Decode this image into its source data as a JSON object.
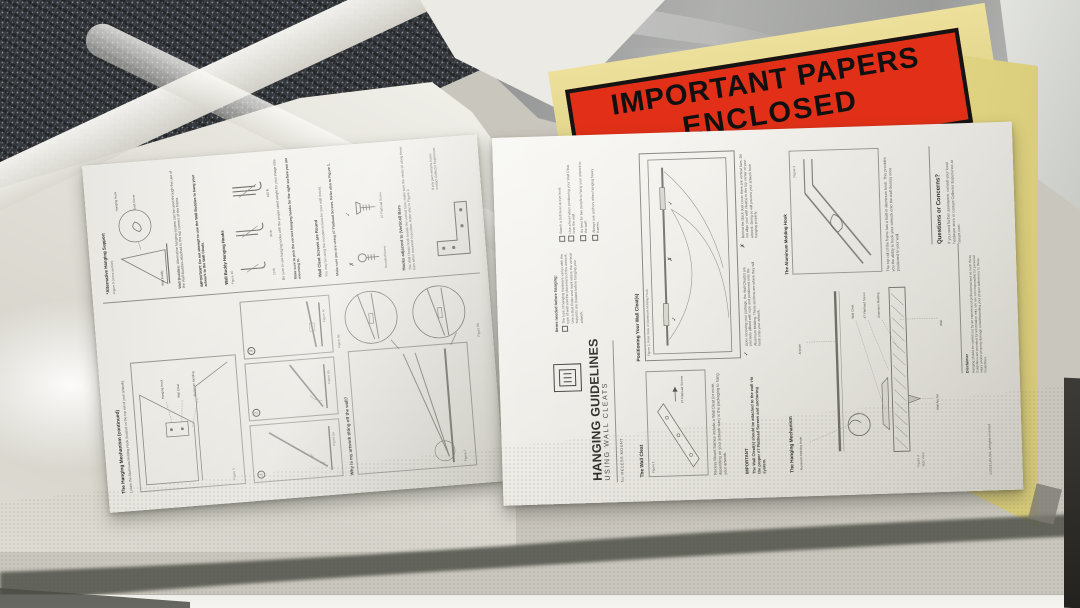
{
  "envelope": {
    "line1": "IMPORTANT PAPERS",
    "line2": "ENCLOSED"
  },
  "marks": {
    "check": "✓",
    "cross": "✗"
  },
  "right": {
    "title": "HANGING GUIDELINES",
    "subtitle": "USING WALL CLEATS",
    "for_line": "for RECESS MOUNT",
    "checklist": {
      "header": "Items needed before hanging:",
      "items": [
        "The type of hanging hardware varies with the type of wall and the placement of the artwork. Use a stud finder and mark where the vertical supports are located before hanging your artwork.",
        "Attach a bolt level at eye level.",
        "Use a level when positioning your Wall Cleat onto the wall.",
        "It's best for two people to hang your artwork to the wall.",
        "Always use anchors when hanging heavy frames."
      ]
    },
    "wall_cleat": {
      "header": "The Wall Cleat",
      "figure": "Figure 1",
      "screw_label": "#7 Flathead Screws",
      "body": "Recess Mount frames include a Wall Cleat (or more, depending on your artwork size) in the packaging to hang your artwork.",
      "important_header": "IMPORTANT",
      "important_body": "The Wall Cleat(s) should be attached to the wall via the proper #7 Flathead Screws and anchoring system."
    },
    "positioning": {
      "header": "Positioning Your Wall Cleat(s)",
      "figure": "Figure 2, Rear View of Aluminum Molding Hook",
      "caption_good": "Upon receiving your package, the Wall Cleat(s) are precisely affixed with rope and positioned onto the Aluminum Molding. These sections are where they will hook onto your artwork.",
      "caption_bad": "Behind the black dust cover there are vertical bars. Do not align your wall cleat(s) to the top center of your artwork. Doing so will prevent your artwork from hanging properly."
    },
    "mechanism": {
      "header": "The Hanging Mechanism",
      "figure": "Figure 4",
      "figure_sub": "Side View",
      "labels": [
        "Aluminum Molding Hook",
        "Artwork",
        "Wall Cleat",
        "#7 Flathead Screw",
        "Aluminum Molding",
        "Wall Anchor",
        "Wall"
      ]
    },
    "molding_hook": {
      "header": "The Aluminum Molding Hook",
      "figure": "Figure 3",
      "body": "The top rail of the frame has a built-in aluminum hook. This provides you the ability to hook your artwork onto the wall cleat(s) once positioned to your wall."
    },
    "questions": {
      "header": "Questions or Concerns?",
      "body": "If you need further assistance, consult your local hardware store or contact Collector Experience at riseart.com."
    },
    "footer": {
      "disclaimer_header": "Disclaimer",
      "disclaimer_body": "Hanging should be carried out by an experienced professional and as such these Guidelines are provided for information only. We are not responsible for personal injury and/or property damage notwithstanding your proper adherence to these Guidelines.",
      "copyright": "©2019 UA USA, all rights reserved"
    }
  },
  "left": {
    "mechanism2": {
      "header": "The Hanging Mechanism (continued)",
      "sub": "Locate the Aluminum Molding Hook (located on the top rail of your artwork).",
      "figure": "Figure 5",
      "labels": [
        "Hanging Hook",
        "Wall Cleat",
        "Aluminum Molding"
      ]
    },
    "steps": {
      "items": [
        {
          "num": "1",
          "figure": "Figure 6a"
        },
        {
          "num": "2",
          "figure": "Figure 6b"
        },
        {
          "num": "3",
          "figure": "Figure 6c"
        }
      ]
    },
    "tilting": {
      "header": "Why is my artwork tilting off the wall?",
      "figure_main": "Figure 7",
      "figure_a": "Figure 8a",
      "figure_b": "Figure 8b"
    },
    "alt_support": {
      "header": "*Alternative Hanging Support",
      "figure": "Figure 9 (cross section)",
      "labels": [
        "Hanging Hook",
        "Wall Buddy",
        "Dust Cover"
      ],
      "body_header": "Wall Buddies:",
      "body": "Alternative hanging system can be used through the use of the Wall Buddies attached to the top corners of the frame.",
      "important": "IMPORTANT: Do not attempt to use the Wall Buddies to hang your artwork to the Wall Cleats."
    },
    "hooks": {
      "header": "Wall Buddy Hanging Hooks",
      "figure": "Figure 10",
      "weights": [
        "10 lb",
        "30 lb",
        "100 lb"
      ],
      "body": "Be sure to use hanging hooks with the proper rated weight for your image size.",
      "note": "Make sure to pick the correct hanging hooks for the right surface you are mounting to."
    },
    "screws": {
      "header": "Wall Cleat Screws are Round",
      "body": "You may be using the rounded screws for your wall mount.",
      "bold": "Make sure you are using #7 Flathead Screws. Refer also to Figure 1.",
      "cross_label": "Rounded Screw",
      "check_label": "#7 Flathead Screw"
    },
    "bars": {
      "header": "Hooks adjacent to (Vertical) Bars",
      "body": "The Wall Cleats hook beside the vertical bars; make sure the cleats sit along these bars when mounted in position. Refer also to Figure 2.",
      "body2": "If any part remains loose, contact Collector Experience."
    }
  }
}
